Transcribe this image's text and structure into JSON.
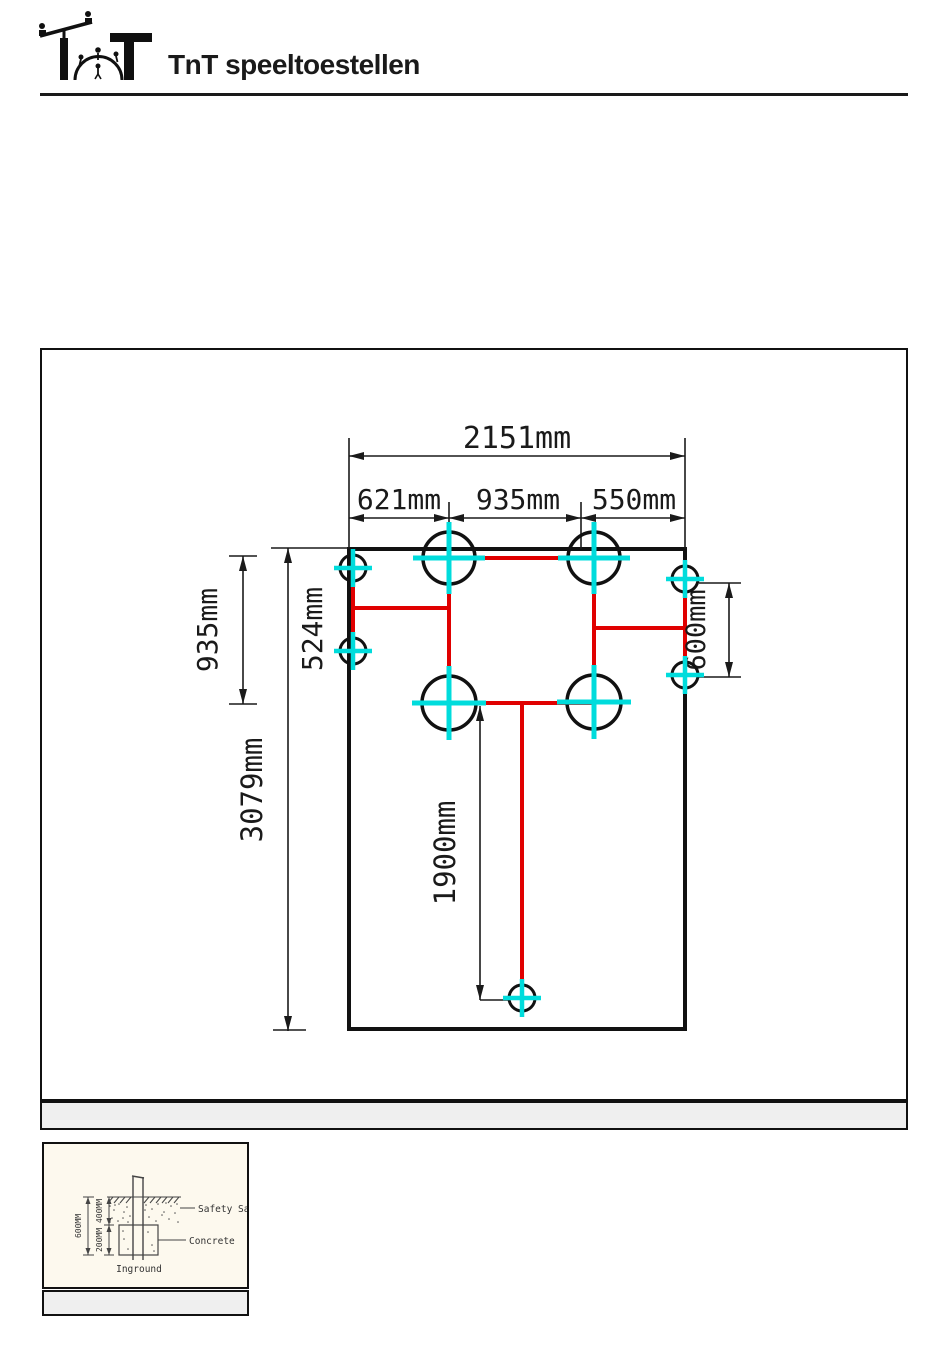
{
  "page": {
    "title": "TnT speeltoestellen"
  },
  "plan": {
    "dim_total_width": "2151mm",
    "dim_seg_left": "621mm",
    "dim_seg_mid": "935mm",
    "dim_seg_right": "550mm",
    "dim_left_upper": "935mm",
    "dim_left_inner": "524mm",
    "dim_total_height": "3079mm",
    "dim_right_posts": "600mm",
    "dim_bottom_post": "1900mm"
  },
  "detail": {
    "label_safety_sand": "Safety Sand",
    "label_concrete": "Concrete",
    "label_inground": "Inground",
    "dim_depth_total": "600MM",
    "dim_depth_sand": "400MM",
    "dim_depth_concrete": "200MM"
  },
  "colors": {
    "beam_red": "#e00000",
    "post_cross_cyan": "#00dcdc",
    "line_black": "#1a1a1a",
    "band_gray": "#efefef",
    "detail_bg_cream": "#fdf9ee"
  }
}
